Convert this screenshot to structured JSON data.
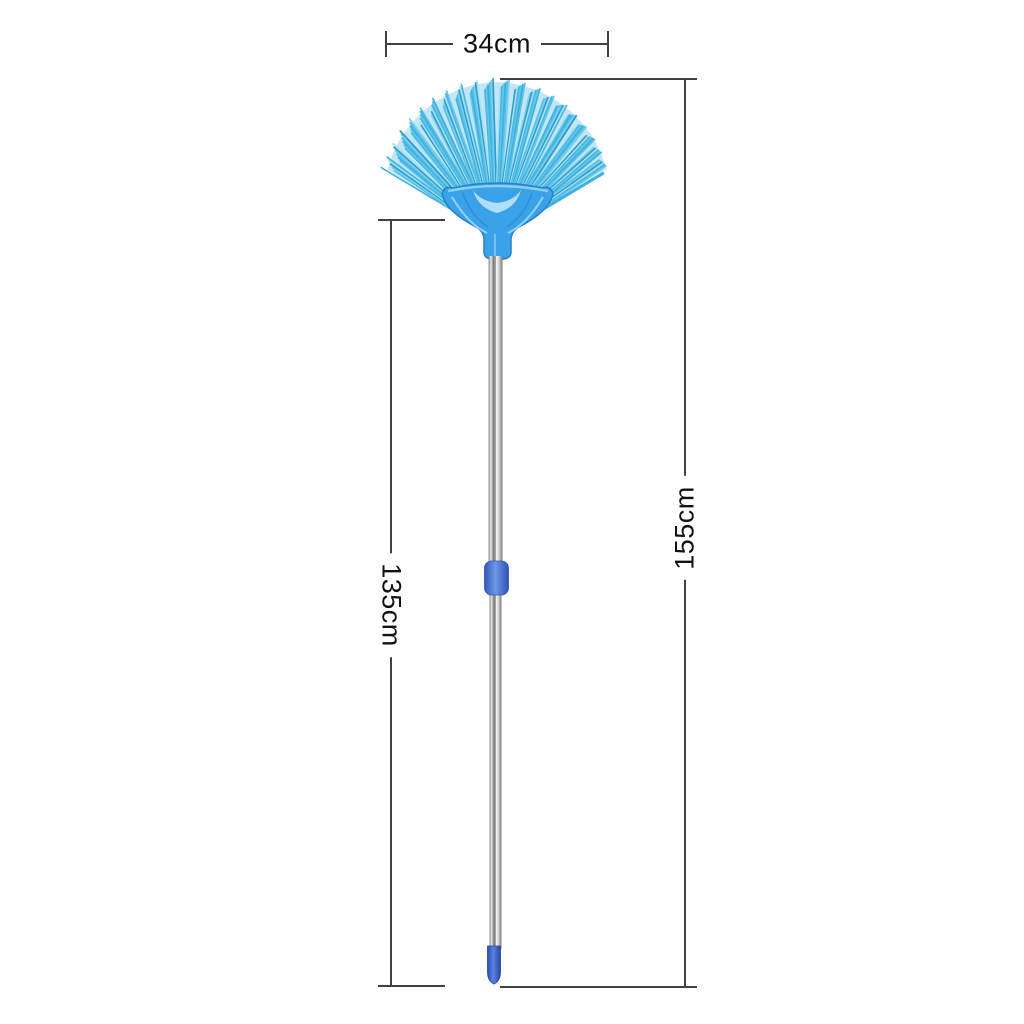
{
  "dimensions": {
    "width": {
      "label": "34cm"
    },
    "handle_length": {
      "label": "135cm"
    },
    "total_length": {
      "label": "155cm"
    }
  },
  "style": {
    "background": "#ffffff",
    "dimension_line_color": "#414141",
    "label_text_color": "#111111",
    "bristle_colors": [
      "#3fb0dd",
      "#56c0e8",
      "#7ccfee",
      "#2f9cc9",
      "#a5e0f4",
      "#49b7e2",
      "#63c6ea"
    ],
    "bristle_fill": "#8ed3ee",
    "head_color": "#3aa2e8",
    "head_outline_color": "#2381c9",
    "head_highlight_color": "#9bd7f6",
    "head_accent_color": "#1f7fd0",
    "collar_color": "#4a7ed2",
    "tip_color": "#3a63cf",
    "pole_highlight": "#fafafa",
    "pole_shadow": "#6c6c6c"
  }
}
